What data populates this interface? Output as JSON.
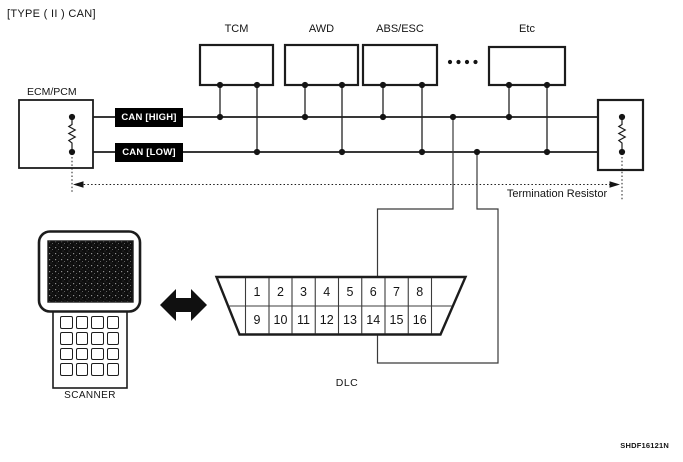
{
  "title": "[TYPE ( II ) CAN]",
  "ecm": {
    "label": "ECM/PCM"
  },
  "modules": [
    {
      "label": "TCM"
    },
    {
      "label": "AWD"
    },
    {
      "label": "ABS/ESC"
    },
    {
      "label": "Etc"
    }
  ],
  "bus": {
    "high_label": "CAN [HIGH]",
    "low_label": "CAN [LOW]",
    "label_bg": "#000000",
    "label_fg": "#ffffff"
  },
  "termination": {
    "label": "Termination Resistor"
  },
  "dlc": {
    "label": "DLC",
    "pins": [
      "1",
      "2",
      "3",
      "4",
      "5",
      "6",
      "7",
      "8",
      "9",
      "10",
      "11",
      "12",
      "13",
      "14",
      "15",
      "16"
    ],
    "can_high_pin": "6",
    "can_low_pin": "14"
  },
  "scanner": {
    "label": "SCANNER"
  },
  "figure_code": "SHDF16121N",
  "colors": {
    "line": "#1c1c1c",
    "background": "#ffffff"
  }
}
